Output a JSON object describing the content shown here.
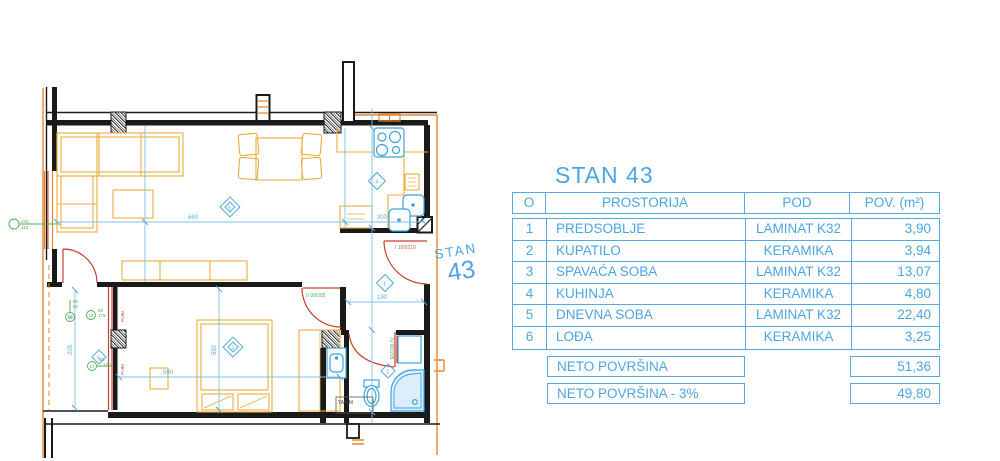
{
  "plan": {
    "stan_word": "STAN",
    "stan_number": "43",
    "doors": {
      "entrance": "I 100/210",
      "bedroom": "II 90/205",
      "bathroom": "IV 80/205"
    },
    "dims": {
      "living_width": "660",
      "kitchen_width": "300",
      "hall_width": "190",
      "bed_length": "590",
      "bed_width": "580",
      "loggia_depth": "205"
    },
    "labels": {
      "parapet": "P=90",
      "ta_vm": "TA/VM",
      "window_left_top": "240",
      "window_left_bot": "110",
      "m15": "15",
      "m16": "16",
      "m17": "17",
      "f15a": "60",
      "f15b": "60",
      "f16a": "60",
      "f16b": "175",
      "f17a": "60",
      "f17b": "175"
    },
    "room_marks": {
      "r1": "1",
      "r2": "2",
      "r3": "3",
      "r4": "4",
      "r5": "5",
      "r6": "6"
    },
    "colors": {
      "wall": "#1a1a1a",
      "furniture": "#ECAC3C",
      "exterior": "#E8862E",
      "door_red": "#C8402F",
      "label_green": "#4CAF50",
      "fixture_cyan": "#3BA4DB",
      "dim_cyan": "#7FC0E5",
      "accent": "#4FA6E4"
    }
  },
  "table": {
    "title": "STAN 43",
    "headers": {
      "no": "O",
      "room": "PROSTORIJA",
      "floor": "POD",
      "area": "POV. (m²)"
    },
    "rows": [
      {
        "no": "1",
        "room": "PREDSOBLJE",
        "floor": "LAMINAT K32",
        "area": "3,90"
      },
      {
        "no": "2",
        "room": "KUPATILO",
        "floor": "KERAMIKA",
        "area": "3,94"
      },
      {
        "no": "3",
        "room": "SPAVAĆA SOBA",
        "floor": "LAMINAT K32",
        "area": "13,07"
      },
      {
        "no": "4",
        "room": "KUHINJA",
        "floor": "KERAMIKA",
        "area": "4,80"
      },
      {
        "no": "5",
        "room": "DNEVNA SOBA",
        "floor": "LAMINAT K32",
        "area": "22,40"
      },
      {
        "no": "6",
        "room": "LOĐA",
        "floor": "KERAMIKA",
        "area": "3,25"
      }
    ],
    "summary": [
      {
        "label": "NETO POVRŠINA",
        "value": "51,36"
      },
      {
        "label": "NETO POVRŠINA - 3%",
        "value": "49,80"
      }
    ]
  }
}
